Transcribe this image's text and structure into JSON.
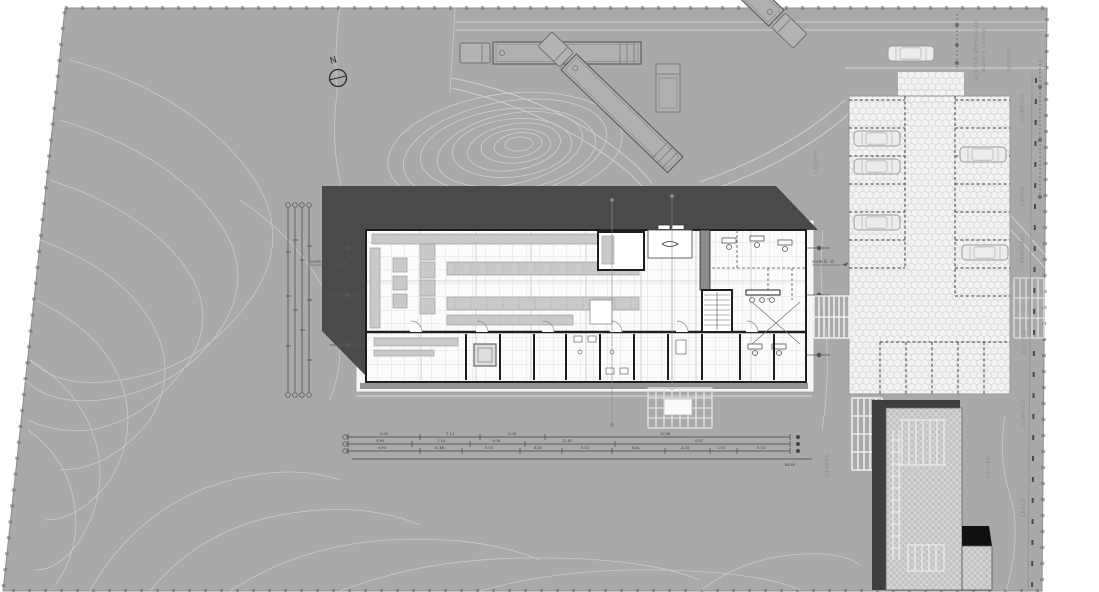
{
  "drawing": {
    "type": "architectural site plan",
    "north_label": "N"
  },
  "labels": {
    "corte_left": "corte B - B",
    "corte_right": "corte B - B",
    "cesped_top": "CÉSPED",
    "cesped_mid": "CÉSPED",
    "cesped_right": "CÉSPED",
    "olimpico_top": "OLÍMPICO",
    "olimpico_mid": "OLÍMPICO",
    "cerco_top": "CERCO",
    "cerco_bottom": "CERCO",
    "peatones": "PEATONES",
    "acceso": "ACCESO",
    "acceso_vehicular_1": "ACCESO VEHICULAR",
    "acceso_vehicular_2": "autos y cargas",
    "porton": "PORTÓN"
  },
  "dimensions": {
    "row1": [
      "5.90",
      "7.14",
      "3.08",
      "10.06"
    ],
    "row2": [
      "5.90",
      "7.14",
      "3.08",
      "12.82",
      "8.81"
    ],
    "row3": [
      "5.90",
      "10.66",
      "5.03",
      "8.85",
      "5.02",
      "8.81",
      "3.04",
      "1.50",
      "5.70"
    ],
    "total": "64.80"
  },
  "colors": {
    "site_gray": "#A9A9A9",
    "roof_shadow": "#4A4A4A",
    "building_fill": "#F8F8F8",
    "wall": "#1E1E1E",
    "paver": "#F2F2F2",
    "contour": "#C9C9C9"
  }
}
